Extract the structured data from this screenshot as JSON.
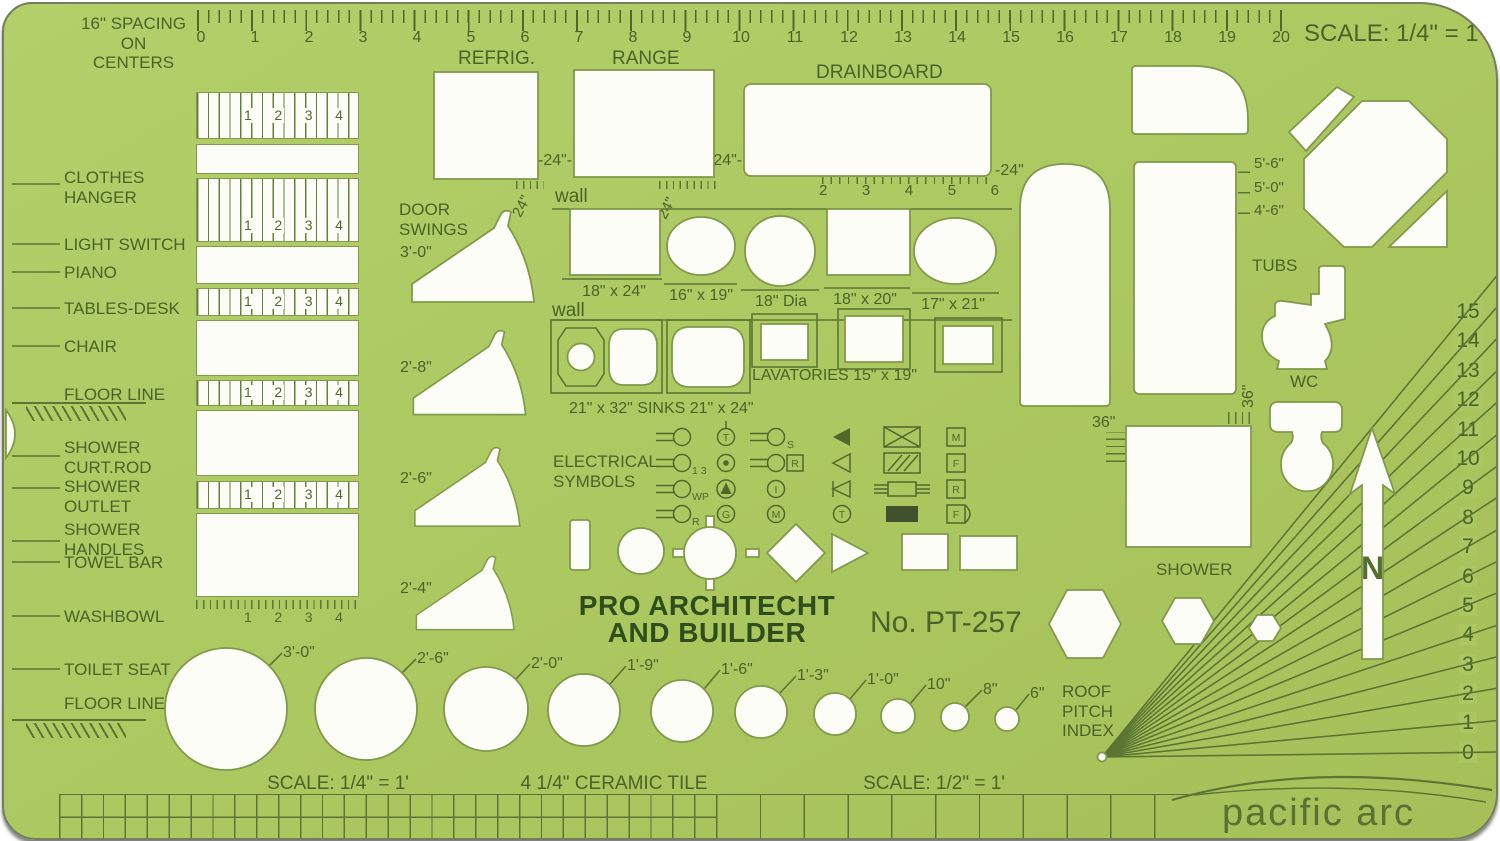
{
  "header": {
    "spacing_note": "16\" SPACING\nON CENTERS",
    "scale": "SCALE: 1/4\" = 1'",
    "ruler_numbers": [
      "0",
      "1",
      "2",
      "3",
      "4",
      "5",
      "6",
      "7",
      "8",
      "9",
      "10",
      "11",
      "12",
      "13",
      "14",
      "15",
      "16",
      "17",
      "18",
      "19",
      "20"
    ]
  },
  "left_labels": {
    "clothes_hanger": "CLOTHES\nHANGER",
    "light_switch": "LIGHT SWITCH",
    "piano": "PIANO",
    "tables_desk": "TABLES-DESK",
    "chair": "CHAIR",
    "floor_line": "FLOOR LINE",
    "shower_curt_rod": "SHOWER\nCURT.ROD",
    "shower_outlet": "SHOWER\nOUTLET",
    "shower_handles": "SHOWER\nHANDLES",
    "towel_bar": "TOWEL BAR",
    "washbowl": "WASHBOWL",
    "toilet_seat": "TOILET SEAT",
    "floor_line2": "FLOOR LINE"
  },
  "left_column": {
    "numbers": [
      "1",
      "2",
      "3",
      "4"
    ]
  },
  "appliances": {
    "refrig": "REFRIG.",
    "range": "RANGE",
    "drainboard": "DRAINBOARD",
    "dim_24_a": "-24\"-",
    "dim_24_b": "-24\"-",
    "dim_24_c": "-24\"",
    "dim_24_rot": "24\"",
    "drain_numbers": [
      "2",
      "3",
      "4",
      "5",
      "6"
    ]
  },
  "door_swings": {
    "title": "DOOR\nSWINGS",
    "sizes": [
      "3'-0\"",
      "2'-8\"",
      "2'-6\"",
      "2'-4\""
    ]
  },
  "sinks": {
    "wall1": "wall",
    "wall2": "wall",
    "row1_labels": [
      "18\" x 24\"",
      "16\" x 19\"",
      "18\" Dia",
      "18\" x 20\"",
      "17\" x 21\""
    ],
    "sinks_label": "21\" x 32\" SINKS 21\" x 24\"",
    "lavatories_label": "LAVATORIES  15\" x 19\""
  },
  "electrical": {
    "title": "ELECTRICAL\nSYMBOLS",
    "sub_s": "S",
    "sub_13": "1 3",
    "sub_wp": "WP",
    "sub_r": "R",
    "circ_t": "T",
    "circ_i": "I",
    "circ_g": "G",
    "circ_m": "M",
    "circ_t2": "T",
    "box_m": "M",
    "box_f": "F",
    "box_r": "R",
    "box_f2": "F",
    "box_r_inline": "R"
  },
  "tubs": {
    "title": "TUBS",
    "tick_labels": [
      "5'-6\"",
      "5'-0\"",
      "4'-6\""
    ],
    "wc": "WC",
    "dim_36_left": "36\"",
    "dim_36_rot": "36\"",
    "shower": "SHOWER"
  },
  "roof": {
    "title": "ROOF\nPITCH\nINDEX",
    "numbers": [
      "15",
      "14",
      "13",
      "12",
      "11",
      "10",
      "9",
      "8",
      "7",
      "6",
      "5",
      "4",
      "3",
      "2",
      "1",
      "0"
    ],
    "north": "N"
  },
  "center": {
    "brand_line1": "PRO ARCHITECHT",
    "brand_line2": "AND BUILDER",
    "model": "No. PT-257"
  },
  "circles": {
    "labels": [
      "3'-0\"",
      "2'-6\"",
      "2'-0\"",
      "1'-9\"",
      "1'-6\"",
      "1'-3\"",
      "1'-0\"",
      "10\"",
      "8\"",
      "6\""
    ]
  },
  "footer": {
    "scale_quarter": "SCALE: 1/4\" = 1'",
    "tile": "4 1/4\" CERAMIC TILE",
    "scale_half": "SCALE: 1/2\" = 1'",
    "logo": "pacific arc"
  },
  "colors": {
    "template_green": "#adc962",
    "line_green": "#5c7533",
    "text_green": "#4a6327",
    "cutout_white": "#fdfdf8"
  }
}
